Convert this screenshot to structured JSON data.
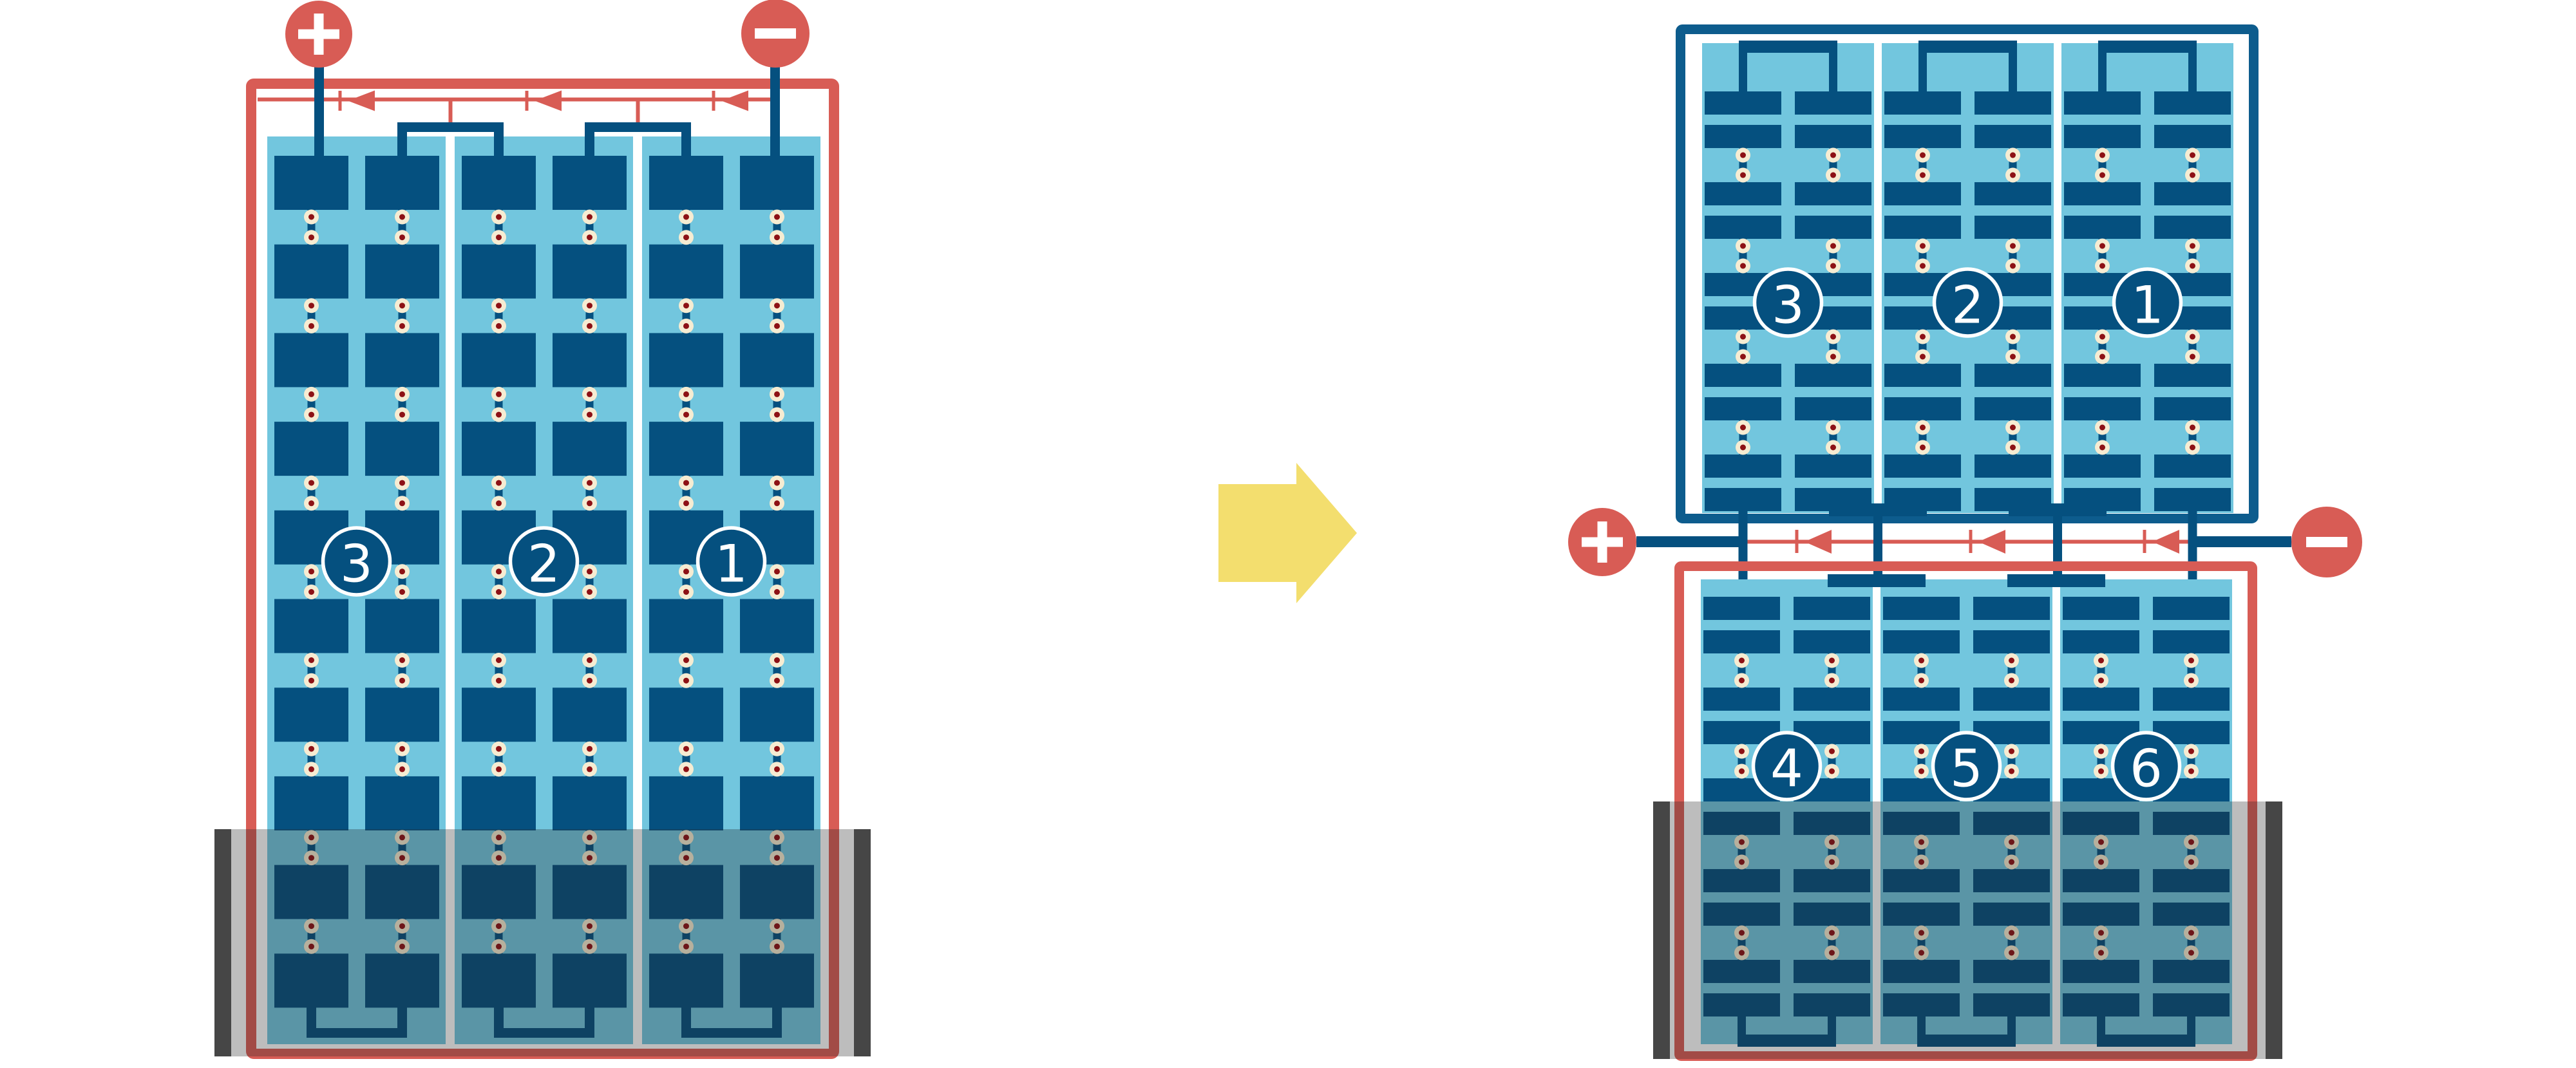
{
  "diagram": {
    "left_module": {
      "terminal_positive": "+",
      "terminal_negative": "−",
      "string_labels": [
        "3",
        "2",
        "1"
      ]
    },
    "right_top_module": {
      "string_labels": [
        "3",
        "2",
        "1"
      ]
    },
    "right_bottom_module": {
      "terminal_positive": "+",
      "terminal_negative": "−",
      "string_labels": [
        "4",
        "5",
        "6"
      ]
    },
    "colors": {
      "red": "#d85c55",
      "cell_blue": "#05507f",
      "frame_blue": "#0d5c8d",
      "light_blue": "#72c6de",
      "cream": "#f6ecd2",
      "dot_red": "#8d1115",
      "yellow": "#f3de6e",
      "white": "#ffffff",
      "shade_rail_gray": "#555555",
      "shade_overlay": "rgba(35,35,35,0.30)"
    }
  }
}
